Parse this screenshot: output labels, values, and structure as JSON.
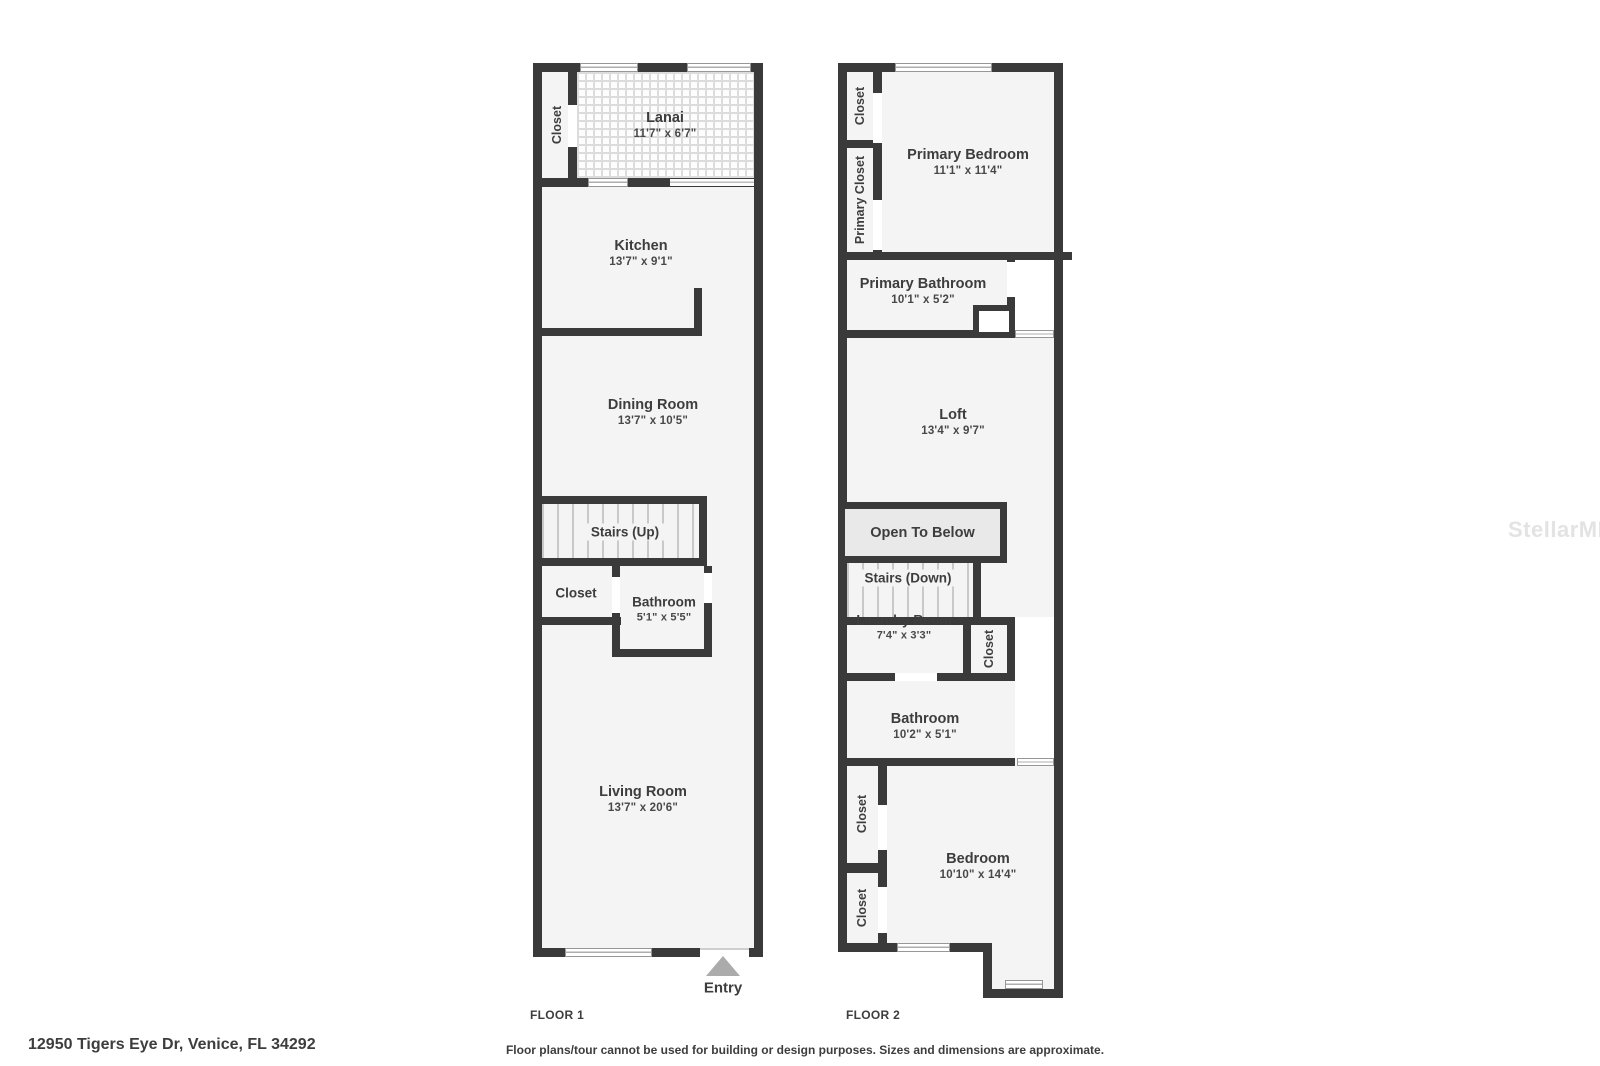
{
  "colors": {
    "wall": "#3a3a3a",
    "room_fill": "#f4f4f4",
    "otb_fill": "#e9e9e9",
    "text": "#3d3d3d",
    "entry_arrow": "#ababab",
    "watermark_color": "#e3e3e3"
  },
  "watermark": "StellarMLS",
  "footer": {
    "address": "12950 Tigers Eye Dr, Venice, FL 34292",
    "disclaimer": "Floor plans/tour cannot be used for building or design purposes. Sizes and dimensions are approximate."
  },
  "floor1": {
    "caption": "FLOOR 1",
    "entry": "Entry",
    "rooms": {
      "closet_top": {
        "name": "Closet"
      },
      "lanai": {
        "name": "Lanai",
        "dims": "11'7\" x 6'7\""
      },
      "kitchen": {
        "name": "Kitchen",
        "dims": "13'7\" x 9'1\""
      },
      "dining_room": {
        "name": "Dining Room",
        "dims": "13'7\" x 10'5\""
      },
      "stairs": {
        "name": "Stairs (Up)"
      },
      "closet_hall": {
        "name": "Closet"
      },
      "bathroom": {
        "name": "Bathroom",
        "dims": "5'1\" x 5'5\""
      },
      "living_room": {
        "name": "Living Room",
        "dims": "13'7\" x 20'6\""
      }
    }
  },
  "floor2": {
    "caption": "FLOOR 2",
    "rooms": {
      "closet_top": {
        "name": "Closet"
      },
      "primary_closet": {
        "name": "Primary Closet"
      },
      "primary_bedroom": {
        "name": "Primary Bedroom",
        "dims": "11'1\" x 11'4\""
      },
      "primary_bathroom": {
        "name": "Primary Bathroom",
        "dims": "10'1\" x 5'2\""
      },
      "loft": {
        "name": "Loft",
        "dims": "13'4\" x 9'7\""
      },
      "open_to_below": {
        "name": "Open To Below"
      },
      "stairs": {
        "name": "Stairs (Down)"
      },
      "laundry_room": {
        "name": "Laundry Room",
        "dims": "7'4\" x 3'3\""
      },
      "laundry_closet": {
        "name": "Closet"
      },
      "bathroom": {
        "name": "Bathroom",
        "dims": "10'2\" x 5'1\""
      },
      "bedroom_closet_1": {
        "name": "Closet"
      },
      "bedroom_closet_2": {
        "name": "Closet"
      },
      "bedroom": {
        "name": "Bedroom",
        "dims": "10'10\" x 14'4\""
      }
    }
  }
}
